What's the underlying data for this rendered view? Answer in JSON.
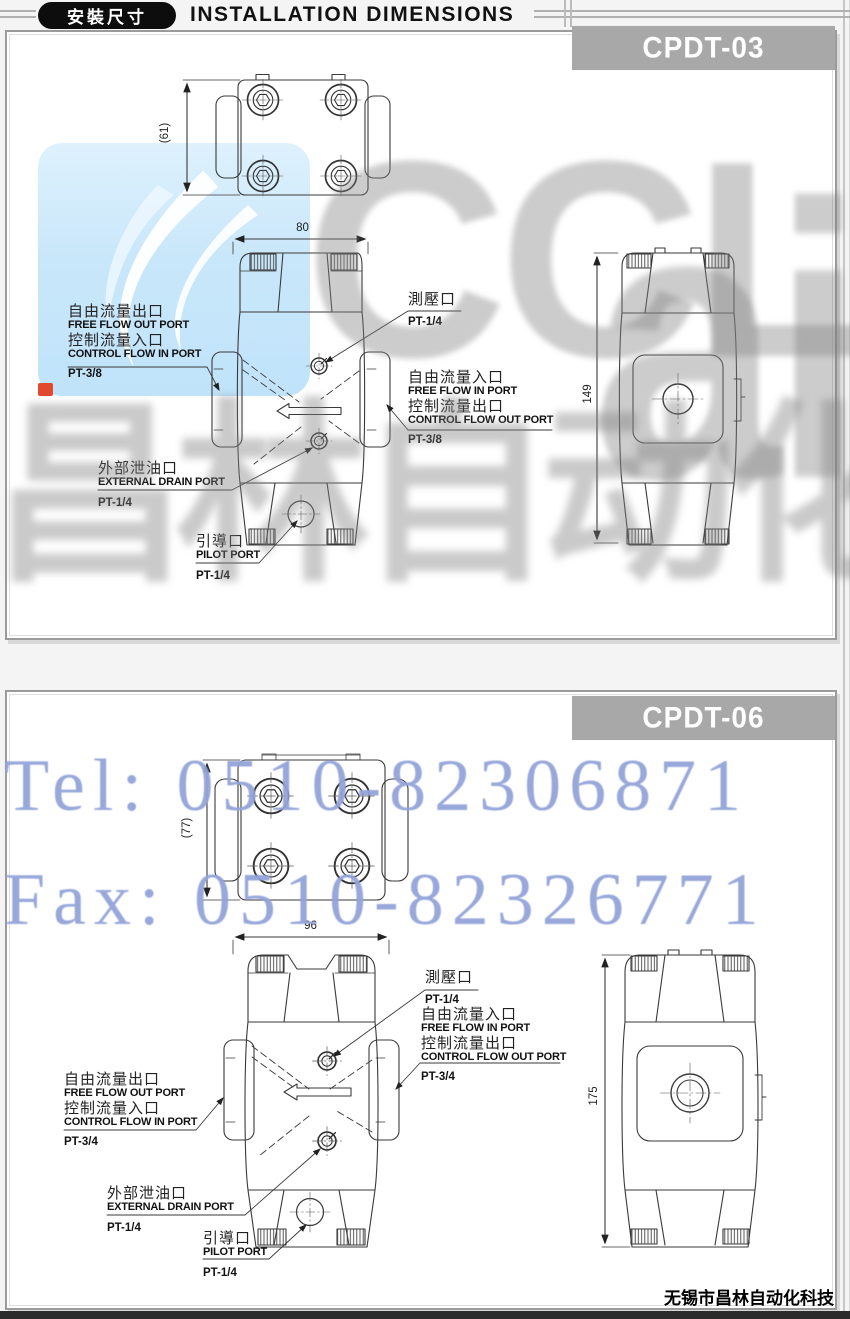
{
  "header": {
    "badge": "安裝尺寸",
    "title": "INSTALLATION DIMENSIONS"
  },
  "watermarks": {
    "brand_part1": "CCL",
    "brand_part2": "air",
    "brand_cn": "昌林自动化",
    "tel": "Tel: 0510-82306871",
    "fax": "Fax: 0510-82326771"
  },
  "colors": {
    "model_box_gray": "#a8a8a8",
    "header_black": "#0d0d0d",
    "watermark_gray": "#808080",
    "watermark_blue": "#92a3d8",
    "logo_blue": "#c5e6fa",
    "logo_red": "#e0492e"
  },
  "footer": {
    "company": "无锡市昌林自动化科技"
  },
  "panels": [
    {
      "model": "CPDT-03",
      "dims": {
        "mount_height": "(61)",
        "body_width": "80",
        "body_height": "149"
      },
      "ports": {
        "gauge": {
          "cn": "測壓口",
          "size": "PT-1/4"
        },
        "out_in": {
          "cn1": "自由流量出口",
          "en1": "FREE FLOW OUT PORT",
          "cn2": "控制流量入口",
          "en2": "CONTROL FLOW IN PORT",
          "size": "PT-3/8"
        },
        "in_out": {
          "cn1": "自由流量入口",
          "en1": "FREE FLOW IN PORT",
          "cn2": "控制流量出口",
          "en2": "CONTROL FLOW OUT PORT",
          "size": "PT-3/8"
        },
        "drain": {
          "cn": "外部泄油口",
          "en": "EXTERNAL DRAIN PORT",
          "size": "PT-1/4"
        },
        "pilot": {
          "cn": "引導口",
          "en": "PILOT PORT",
          "size": "PT-1/4"
        }
      }
    },
    {
      "model": "CPDT-06",
      "dims": {
        "mount_height": "(77)",
        "body_width": "96",
        "body_height": "175"
      },
      "ports": {
        "gauge": {
          "cn": "測壓口",
          "size": "PT-1/4"
        },
        "out_in": {
          "cn1": "自由流量出口",
          "en1": "FREE FLOW OUT PORT",
          "cn2": "控制流量入口",
          "en2": "CONTROL FLOW IN PORT",
          "size": "PT-3/4"
        },
        "in_out": {
          "cn1": "自由流量入口",
          "en1": "FREE FLOW IN PORT",
          "cn2": "控制流量出口",
          "en2": "CONTROL FLOW OUT PORT",
          "size": "PT-3/4"
        },
        "drain": {
          "cn": "外部泄油口",
          "en": "EXTERNAL DRAIN PORT",
          "size": "PT-1/4"
        },
        "pilot": {
          "cn": "引導口",
          "en": "PILOT PORT",
          "size": "PT-1/4"
        }
      }
    }
  ]
}
